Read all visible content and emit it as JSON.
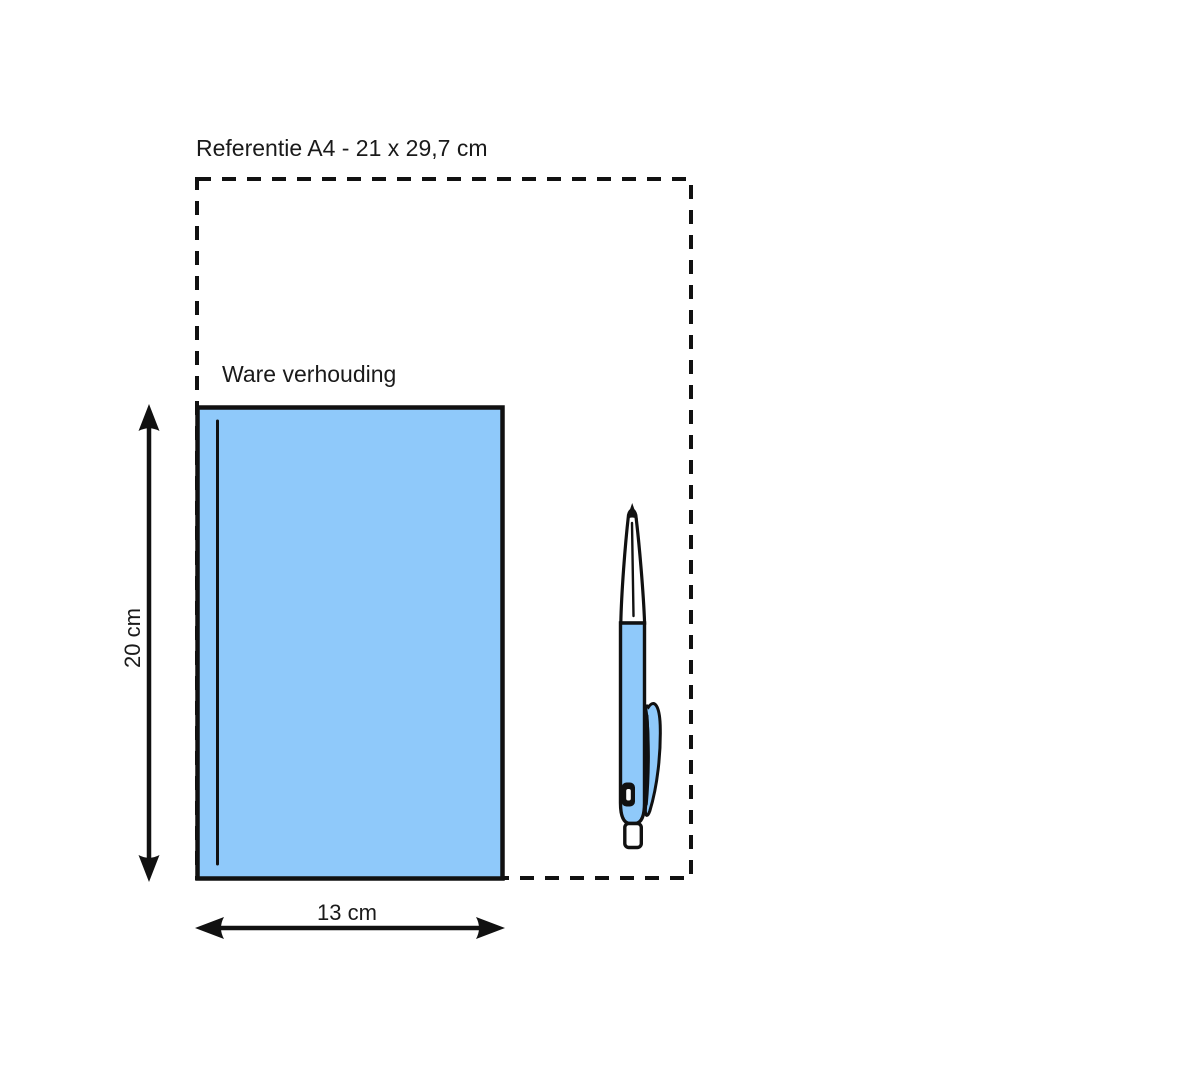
{
  "reference": {
    "label": "Referentie A4 - 21 x 29,7 cm"
  },
  "book": {
    "label": "Ware verhouding",
    "height_label": "20 cm",
    "width_label": "13 cm"
  },
  "icons": {
    "pen": "ballpoint-pen-illustration"
  },
  "colors": {
    "object_fill": "#8fc9fa",
    "outline": "#111111",
    "background": "#ffffff"
  }
}
